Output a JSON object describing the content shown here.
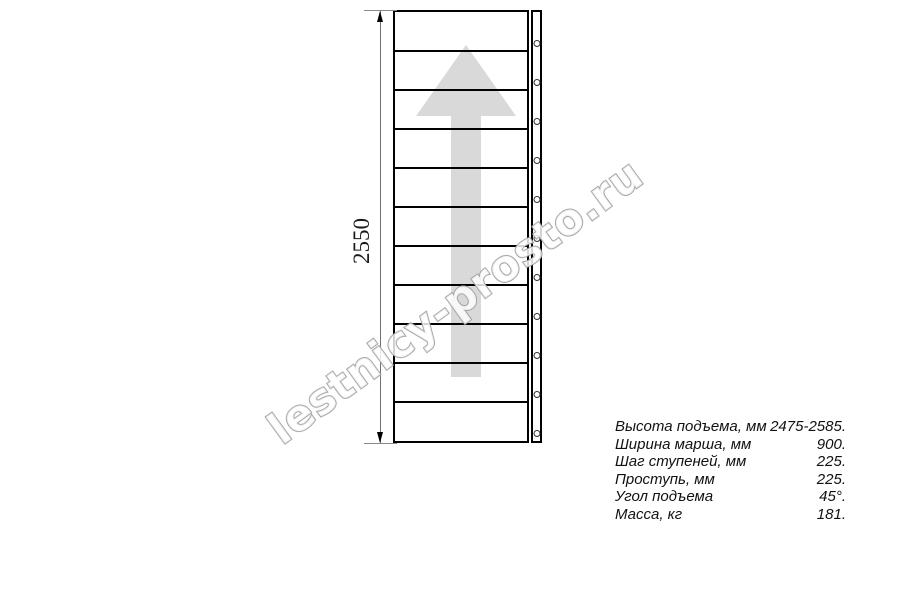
{
  "watermark": {
    "text": "lestnicy-prosto.ru"
  },
  "drawing": {
    "type": "staircase-plan",
    "dimension_label": "2550",
    "steps_count": 11,
    "arrow_direction": "up"
  },
  "specs": {
    "rows": [
      {
        "label": "Высота подъема, мм",
        "value": "2475-2585."
      },
      {
        "label": "Ширина марша, мм",
        "value": "900."
      },
      {
        "label": "Шаг ступеней, мм",
        "value": "225."
      },
      {
        "label": "Проступь, мм",
        "value": "225."
      },
      {
        "label": "Угол подъема",
        "value": "45°."
      },
      {
        "label": "Масса, кг",
        "value": "181."
      }
    ]
  },
  "colors": {
    "line": "#000000",
    "dim_line": "#707070",
    "arrow_fill": "#d9d9d9",
    "watermark_stroke": "#9e9e9e"
  }
}
